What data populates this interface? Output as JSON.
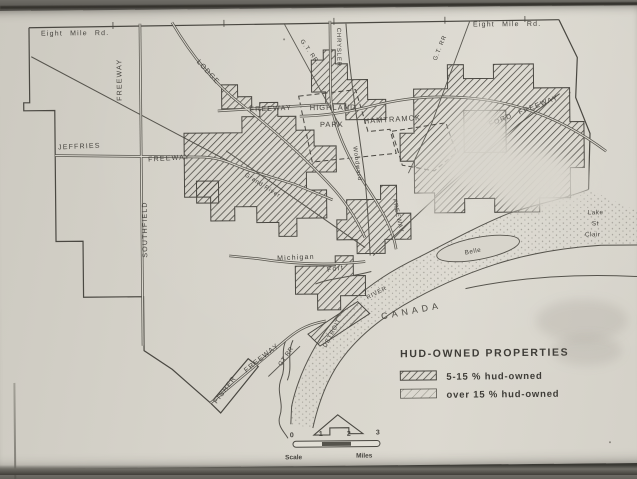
{
  "colors": {
    "paper": "#d8d5cc",
    "ink": "#45433e",
    "line": "#56544d",
    "hatch": "#4a4842"
  },
  "map": {
    "roads": {
      "eight_mile_left": "Eight Mile Rd.",
      "eight_mile_right": "Eight Mile Rd.",
      "southfield_freeway_top": "FREEWAY",
      "southfield": "SOUTHFIELD",
      "lodge": "LODGE",
      "gt_rr_center": "G.T. RR.",
      "gt_rr_right": "G.T. RR",
      "gt_rr_south": "GT RR",
      "chrysler": "CHRYSLER",
      "chrysler_freeway_mid": "FREEWAY",
      "ford_freeway": "FORD FREEWAY",
      "jeffries": "JEFFRIES",
      "jeffries_freeway": "FREEWAY",
      "davison_freeway": "FREEWAY",
      "grand_river": "Grand River",
      "woodward": "Woodward",
      "michigan": "Michigan",
      "fort": "Fort",
      "fisher": "FISHER",
      "fisher_freeway": "FREEWAY"
    },
    "places": {
      "highland": "HIGHLAND",
      "park": "PARK",
      "hamtramck": "HAMTRAMCK",
      "canada": "CANADA",
      "detroit": "DETROIT",
      "river": "RIVER",
      "belle": "Belle",
      "lake_line1": "Lake",
      "lake_line2": "St",
      "lake_line3": "Clair"
    }
  },
  "legend": {
    "title": "HUD-OWNED PROPERTIES",
    "items": [
      {
        "swatch": "hatch-dense",
        "label": "5-15 % hud-owned"
      },
      {
        "swatch": "hatch-light",
        "label": "over 15 % hud-owned"
      }
    ]
  },
  "scale": {
    "ticks": [
      "0",
      "1",
      "2",
      "3"
    ],
    "left_label": "Scale",
    "right_label": "Miles"
  }
}
